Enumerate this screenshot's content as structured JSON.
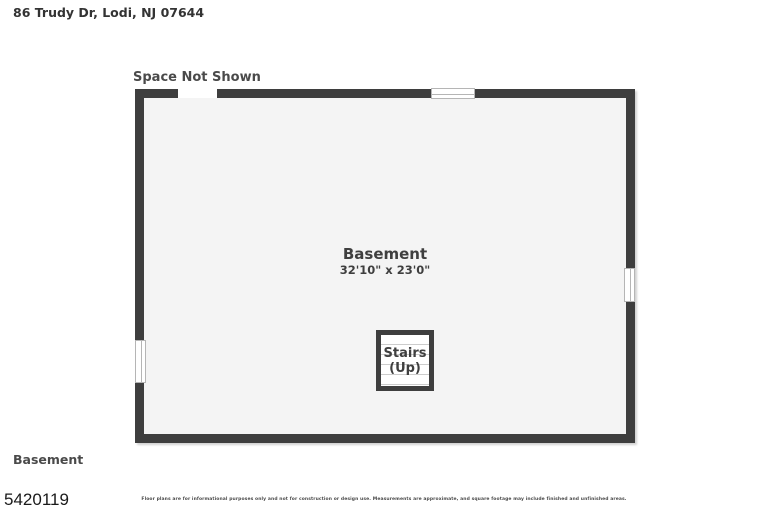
{
  "header": {
    "address": "86 Trudy Dr, Lodi, NJ 07644"
  },
  "plan": {
    "space_not_shown_label": "Space Not Shown",
    "room_name": "Basement",
    "room_dimensions": "32'10\" x 23'0\"",
    "stairs_label_line1": "Stairs",
    "stairs_label_line2": "(Up)",
    "colors": {
      "wall": "#3e3e3e",
      "floor": "#f4f4f4",
      "window_line": "#b5b5b5",
      "stair_tread": "#cccccc"
    }
  },
  "footer": {
    "floor_label": "Basement",
    "plan_id": "5420119",
    "disclaimer": "Floor plans are for informational purposes only and not for construction or design use. Measurements are approximate, and square footage may include finished and unfinished areas."
  }
}
